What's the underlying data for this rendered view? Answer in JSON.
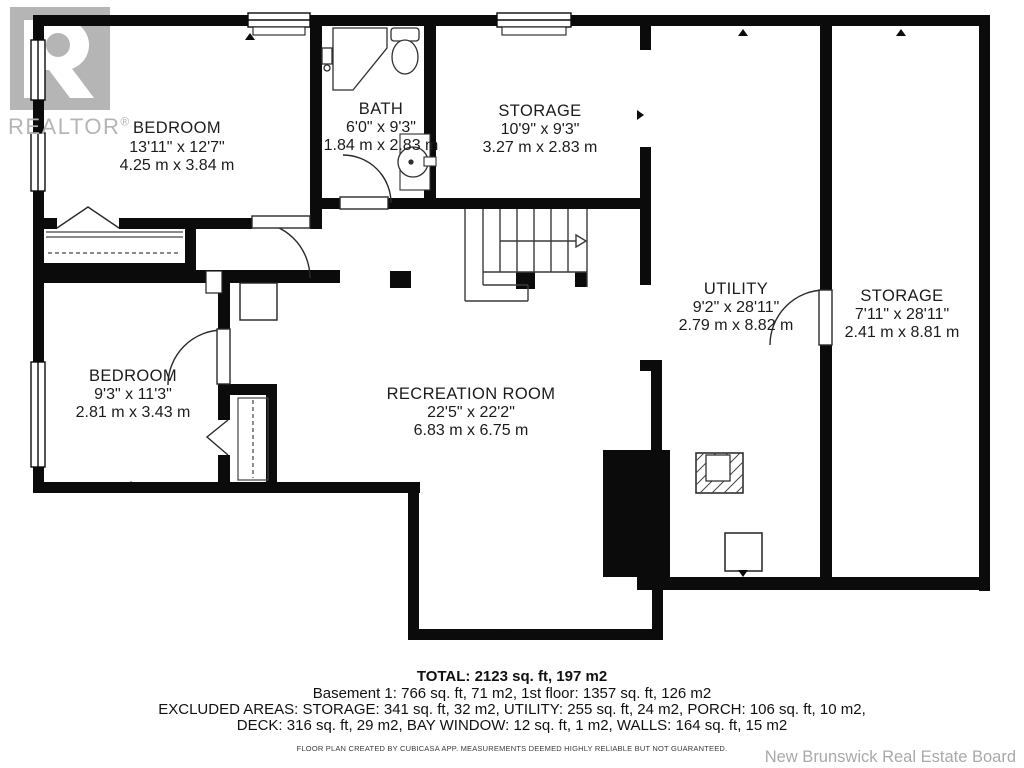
{
  "branding": {
    "realtor_logo_text": "REALTOR",
    "registered_mark": "®",
    "board_credit": "New Brunswick Real Estate Board",
    "logo_gray": "#b5b5b5"
  },
  "rooms": [
    {
      "id": "bedroom-upper",
      "name": "BEDROOM",
      "imperial": "13'11\" x 12'7\"",
      "metric": "4.25 m x 3.84 m"
    },
    {
      "id": "bath",
      "name": "BATH",
      "imperial": "6'0\" x 9'3\"",
      "metric": "1.84 m x 2.83 m"
    },
    {
      "id": "storage-upper",
      "name": "STORAGE",
      "imperial": "10'9\" x 9'3\"",
      "metric": "3.27 m x 2.83 m"
    },
    {
      "id": "utility",
      "name": "UTILITY",
      "imperial": "9'2\" x 28'11\"",
      "metric": "2.79 m x 8.82 m"
    },
    {
      "id": "storage-right",
      "name": "STORAGE",
      "imperial": "7'11\" x 28'11\"",
      "metric": "2.41 m x 8.81 m"
    },
    {
      "id": "bedroom-lower",
      "name": "BEDROOM",
      "imperial": "9'3\" x 11'3\"",
      "metric": "2.81 m x 3.43 m"
    },
    {
      "id": "recreation-room",
      "name": "RECREATION ROOM",
      "imperial": "22'5\" x 22'2\"",
      "metric": "6.83 m x 6.75 m"
    }
  ],
  "summary": {
    "total": "TOTAL: 2123 sq. ft, 197 m2",
    "floors": "Basement 1: 766 sq. ft, 71 m2, 1st floor: 1357 sq. ft, 126 m2",
    "excluded_1": "EXCLUDED AREAS: STORAGE: 341 sq. ft, 32 m2, UTILITY: 255 sq. ft, 24 m2, PORCH: 106 sq. ft, 10 m2,",
    "excluded_2": "DECK: 316 sq. ft, 29 m2, BAY WINDOW: 12 sq. ft, 1 m2, WALLS: 164 sq. ft, 15 m2",
    "disclaimer": "FLOOR PLAN CREATED BY CUBICASA APP. MEASUREMENTS DEEMED HIGHLY RELIABLE BUT NOT GUARANTEED."
  },
  "colors": {
    "wall": "#0b0b0b",
    "text": "#1c1c1c",
    "credit_gray": "#a9a9a9"
  }
}
